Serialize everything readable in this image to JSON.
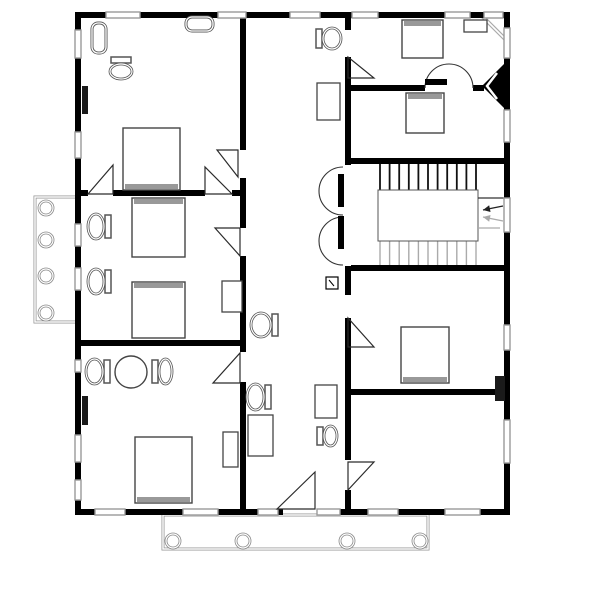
{
  "figure": {
    "name": "house-floor-plan",
    "width": 604,
    "height": 604
  },
  "colors": {
    "bg": "#ffffff",
    "wall": "#000000",
    "door_line": "#2b2b2b",
    "fixture": "#555555",
    "fixture_inner": "#ffffff",
    "thin": "#444444",
    "gray": "#999999",
    "light": "#aaaaaa",
    "headboard": "#999999",
    "tread_dark": "#111111",
    "tread_light": "#aaaaaa",
    "porch": "#999999",
    "column": "#888888"
  },
  "walls": [
    [
      75,
      12,
      31,
      6
    ],
    [
      140,
      12,
      78,
      6
    ],
    [
      246,
      12,
      44,
      6
    ],
    [
      320,
      12,
      32,
      6
    ],
    [
      378,
      12,
      67,
      6
    ],
    [
      470,
      12,
      14,
      6
    ],
    [
      503,
      12,
      7,
      6
    ],
    [
      75,
      509,
      20,
      6
    ],
    [
      125,
      509,
      58,
      6
    ],
    [
      218,
      509,
      40,
      6
    ],
    [
      278,
      509,
      5,
      6
    ],
    [
      340,
      509,
      28,
      6
    ],
    [
      398,
      509,
      47,
      6
    ],
    [
      480,
      509,
      30,
      6
    ],
    [
      75,
      12,
      6,
      18
    ],
    [
      75,
      58,
      6,
      74
    ],
    [
      75,
      158,
      6,
      66
    ],
    [
      75,
      246,
      6,
      22
    ],
    [
      75,
      290,
      6,
      70
    ],
    [
      75,
      372,
      6,
      63
    ],
    [
      75,
      462,
      6,
      18
    ],
    [
      75,
      500,
      6,
      15
    ],
    [
      504,
      12,
      6,
      16
    ],
    [
      504,
      58,
      6,
      52
    ],
    [
      504,
      142,
      6,
      56
    ],
    [
      504,
      232,
      6,
      93
    ],
    [
      504,
      350,
      6,
      70
    ],
    [
      504,
      463,
      6,
      52
    ],
    [
      240,
      12,
      6,
      138
    ],
    [
      240,
      178,
      6,
      50
    ],
    [
      240,
      256,
      6,
      96
    ],
    [
      240,
      382,
      6,
      133
    ],
    [
      345,
      12,
      6,
      18
    ],
    [
      345,
      57,
      6,
      108
    ],
    [
      345,
      266,
      6,
      29
    ],
    [
      345,
      318,
      6,
      142
    ],
    [
      345,
      490,
      6,
      25
    ],
    [
      81,
      190,
      7,
      6
    ],
    [
      113,
      190,
      92,
      6
    ],
    [
      232,
      190,
      8,
      6
    ],
    [
      81,
      340,
      159,
      6
    ],
    [
      351,
      85,
      74,
      6
    ],
    [
      473,
      85,
      11,
      6
    ],
    [
      351,
      158,
      153,
      6
    ],
    [
      351,
      265,
      153,
      6
    ],
    [
      351,
      389,
      153,
      6
    ]
  ],
  "windows": [
    [
      106,
      12,
      34,
      6
    ],
    [
      218,
      12,
      28,
      6
    ],
    [
      290,
      12,
      30,
      6
    ],
    [
      352,
      12,
      26,
      6
    ],
    [
      445,
      12,
      25,
      6
    ],
    [
      484,
      12,
      19,
      6
    ],
    [
      95,
      509,
      30,
      6
    ],
    [
      183,
      509,
      35,
      6
    ],
    [
      258,
      509,
      20,
      6
    ],
    [
      317,
      509,
      23,
      6
    ],
    [
      368,
      509,
      30,
      6
    ],
    [
      445,
      509,
      35,
      6
    ],
    [
      75,
      30,
      6,
      28
    ],
    [
      75,
      132,
      6,
      26
    ],
    [
      75,
      224,
      6,
      22
    ],
    [
      75,
      268,
      6,
      22
    ],
    [
      75,
      360,
      6,
      12
    ],
    [
      75,
      435,
      6,
      27
    ],
    [
      75,
      480,
      6,
      20
    ],
    [
      504,
      28,
      6,
      30
    ],
    [
      504,
      110,
      6,
      32
    ],
    [
      504,
      198,
      6,
      34
    ],
    [
      504,
      325,
      6,
      25
    ],
    [
      504,
      420,
      6,
      43
    ]
  ],
  "chimneys": [
    [
      82,
      86,
      6,
      28
    ],
    [
      82,
      396,
      6,
      29
    ],
    [
      495,
      376,
      10,
      25
    ]
  ],
  "porches": [
    {
      "rect": [
        35,
        197,
        43,
        125
      ],
      "cols": [
        [
          46,
          208
        ],
        [
          46,
          240
        ],
        [
          46,
          276
        ],
        [
          46,
          313
        ]
      ],
      "col_radius": 7
    },
    {
      "rect": [
        163,
        515,
        265,
        34
      ],
      "cols": [
        [
          173,
          541
        ],
        [
          243,
          541
        ],
        [
          347,
          541
        ],
        [
          420,
          541
        ]
      ],
      "col_radius": 7
    }
  ],
  "stairs": {
    "treads_dark": {
      "x1": 380,
      "x2": 476,
      "count": 11,
      "y1": 164,
      "y2": 190
    },
    "treads_light": {
      "x1": 380,
      "x2": 476,
      "count": 11,
      "y1": 241,
      "y2": 265
    },
    "landing": [
      378,
      190,
      100,
      51
    ],
    "guide_lines": [
      {
        "pts": [
          478,
          198,
          504,
          198
        ],
        "tone": "dark"
      },
      {
        "pts": [
          478,
          228,
          500,
          228
        ],
        "tone": "light"
      }
    ],
    "arrows": [
      {
        "x1": 503,
        "y1": 206,
        "x2": 483,
        "y2": 210,
        "tone": "dark"
      },
      {
        "x1": 503,
        "y1": 221,
        "x2": 483,
        "y2": 217,
        "tone": "light"
      }
    ]
  },
  "doors": {
    "triangles": [
      {
        "pts": [
          [
            88,
            194
          ],
          [
            113,
            165
          ],
          [
            113,
            194
          ]
        ]
      },
      {
        "pts": [
          [
            205,
            167
          ],
          [
            205,
            194
          ],
          [
            232,
            194
          ]
        ]
      },
      {
        "pts": [
          [
            217,
            150
          ],
          [
            238,
            150
          ],
          [
            238,
            177
          ]
        ]
      },
      {
        "pts": [
          [
            215,
            228
          ],
          [
            240,
            228
          ],
          [
            240,
            256
          ]
        ]
      },
      {
        "pts": [
          [
            213,
            383
          ],
          [
            240,
            353
          ],
          [
            240,
            383
          ]
        ]
      },
      {
        "pts": [
          [
            277,
            509
          ],
          [
            315,
            472
          ],
          [
            315,
            509
          ]
        ]
      },
      {
        "pts": [
          [
            348,
            57
          ],
          [
            348,
            78
          ],
          [
            374,
            78
          ]
        ]
      },
      {
        "pts": [
          [
            348,
            318
          ],
          [
            348,
            347
          ],
          [
            374,
            347
          ]
        ]
      },
      {
        "pts": [
          [
            348,
            462
          ],
          [
            374,
            462
          ],
          [
            348,
            490
          ]
        ]
      }
    ],
    "arcs": [
      {
        "d": "M343 167 A24 24 0 0 0 343 215"
      },
      {
        "d": "M343 217 A24 24 0 0 0 343 265"
      },
      {
        "d": "M425 88 A24 24 0 0 1 473 88"
      }
    ],
    "bars": [
      [
        338,
        174,
        6,
        33
      ],
      [
        338,
        216,
        6,
        33
      ],
      [
        425,
        79,
        22,
        6
      ]
    ]
  },
  "furniture": {
    "beds": [
      {
        "x": 123,
        "y": 128,
        "w": 57,
        "h": 62,
        "head": "bottom"
      },
      {
        "x": 402,
        "y": 20,
        "w": 41,
        "h": 38,
        "head": "top"
      },
      {
        "x": 406,
        "y": 93,
        "w": 38,
        "h": 40,
        "head": "top"
      },
      {
        "x": 132,
        "y": 198,
        "w": 53,
        "h": 59,
        "head": "top"
      },
      {
        "x": 132,
        "y": 282,
        "w": 53,
        "h": 56,
        "head": "top"
      },
      {
        "x": 401,
        "y": 327,
        "w": 48,
        "h": 56,
        "head": "bottom"
      },
      {
        "x": 135,
        "y": 437,
        "w": 57,
        "h": 66,
        "head": "bottom"
      }
    ],
    "cabinets": [
      [
        317,
        83,
        23,
        37
      ],
      [
        464,
        20,
        23,
        12
      ],
      [
        222,
        281,
        20,
        31
      ],
      [
        223,
        432,
        15,
        35
      ],
      [
        248,
        415,
        25,
        41
      ],
      [
        315,
        385,
        22,
        33
      ]
    ],
    "rounded_fixtures": [
      [
        92,
        23,
        14,
        30
      ],
      [
        186,
        17,
        27,
        14
      ]
    ],
    "toilets": [
      {
        "x": 109,
        "y": 57,
        "w": 24,
        "h": 23,
        "flat": "top"
      },
      {
        "x": 316,
        "y": 27,
        "w": 26,
        "h": 23,
        "flat": "left"
      },
      {
        "x": 87,
        "y": 213,
        "w": 24,
        "h": 27,
        "flat": "right"
      },
      {
        "x": 87,
        "y": 268,
        "w": 24,
        "h": 27,
        "flat": "right"
      },
      {
        "x": 250,
        "y": 312,
        "w": 28,
        "h": 26,
        "flat": "right"
      },
      {
        "x": 246,
        "y": 383,
        "w": 25,
        "h": 28,
        "flat": "right"
      },
      {
        "x": 317,
        "y": 425,
        "w": 21,
        "h": 22,
        "flat": "left"
      },
      {
        "x": 85,
        "y": 358,
        "w": 25,
        "h": 27,
        "flat": "right"
      },
      {
        "x": 152,
        "y": 358,
        "w": 21,
        "h": 27,
        "flat": "left"
      }
    ],
    "table": {
      "cx": 131,
      "cy": 372,
      "r": 16
    }
  },
  "symbols": {
    "thermostat": {
      "x": 326,
      "y": 277,
      "s": 12
    },
    "corner_fireplace": {
      "tri": [
        [
          504,
          64
        ],
        [
          504,
          108
        ],
        [
          482,
          86
        ]
      ],
      "chevron": [
        [
          497,
          73
        ],
        [
          487,
          86
        ],
        [
          497,
          99
        ]
      ]
    },
    "corner_trim": {
      "x1": 480,
      "y1": 14,
      "x2": 508,
      "y2": 42
    }
  }
}
